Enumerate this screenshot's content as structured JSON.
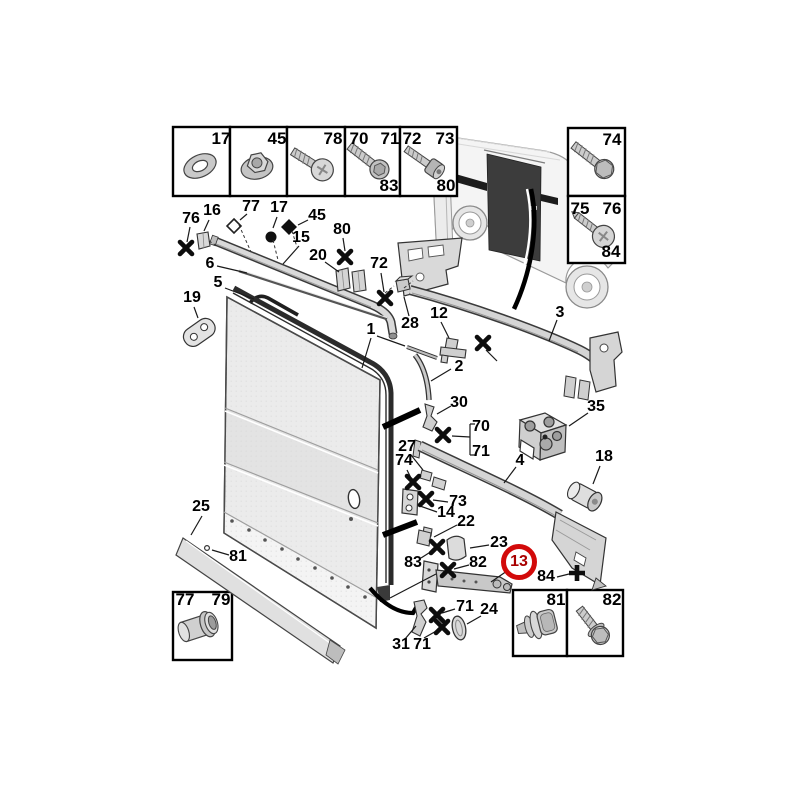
{
  "document": {
    "type": "exploded-parts-diagram",
    "subject": "van sliding side door panel, guide rails, hinges and fasteners",
    "background": "#ffffff"
  },
  "highlight": {
    "part_number": "13",
    "ring_color": "#d20a0a"
  },
  "part_numbers": {
    "1": "1",
    "2": "2",
    "3": "3",
    "4": "4",
    "5": "5",
    "6": "6",
    "12": "12",
    "13": "13",
    "14": "14",
    "15": "15",
    "16": "16",
    "17": "17",
    "18": "18",
    "19": "19",
    "20": "20",
    "22": "22",
    "23": "23",
    "24": "24",
    "25": "25",
    "27": "27",
    "28": "28",
    "30": "30",
    "31": "31",
    "35": "35",
    "45": "45",
    "70": "70",
    "71": "71",
    "72": "72",
    "73": "73",
    "74": "74",
    "75": "75",
    "76": "76",
    "77": "77",
    "78": "78",
    "79": "79",
    "80": "80",
    "81": "81",
    "82": "82",
    "83": "83",
    "84": "84"
  },
  "legend_boxes": {
    "top_row": [
      {
        "item": "washer-icon",
        "labels": {
          "tr": "17"
        }
      },
      {
        "item": "flange-nut-icon",
        "labels": {
          "tr": "45"
        }
      },
      {
        "item": "pan-head-screw-icon",
        "labels": {
          "tr": "78"
        }
      },
      {
        "item": "hex-flange-screw-icon",
        "labels": {
          "tl": "70",
          "tr": "71",
          "br": "83"
        }
      },
      {
        "item": "socket-head-screw-icon",
        "labels": {
          "tl": "72",
          "tr": "73",
          "br": "80"
        }
      }
    ],
    "right_column": [
      {
        "item": "hex-bolt-icon",
        "labels": {
          "tr": "74"
        }
      },
      {
        "item": "phillips-screw-icon",
        "labels": {
          "tl": "75",
          "tr": "76",
          "br": "84"
        }
      }
    ],
    "bottom_left": [
      {
        "item": "rivet-nut-icon",
        "labels": {
          "tl": "77",
          "tr": "79"
        }
      }
    ],
    "bottom_right": [
      {
        "item": "push-plug-icon",
        "labels": {
          "tr": "81"
        }
      },
      {
        "item": "hex-screw-icon",
        "labels": {
          "tr": "82"
        }
      }
    ]
  }
}
